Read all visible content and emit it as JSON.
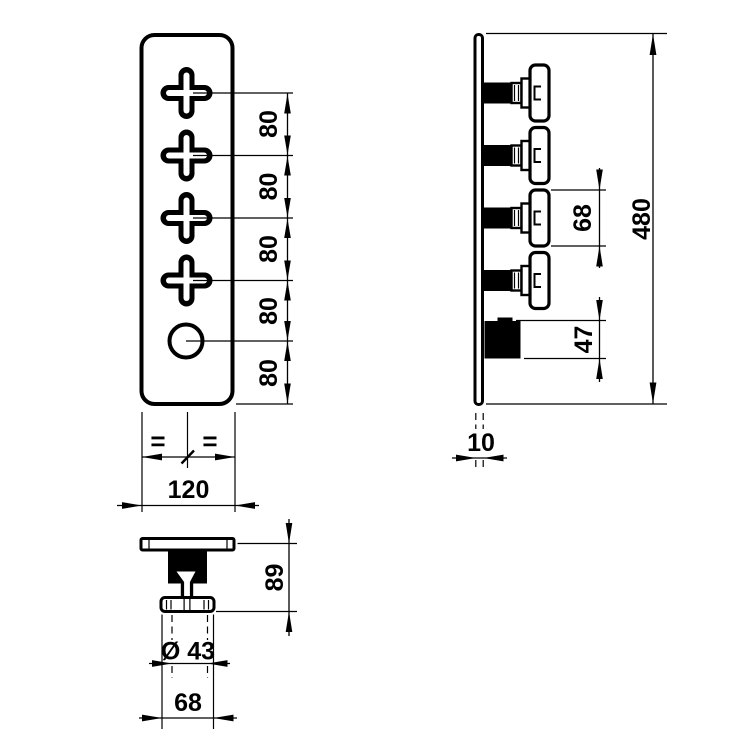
{
  "drawing": {
    "kind": "technical-dimension-drawing",
    "background_color": "#ffffff",
    "line_color": "#000000"
  },
  "front_view": {
    "spacing_dims": [
      "80",
      "80",
      "80",
      "80",
      "80"
    ],
    "equal_marks": [
      "=",
      "="
    ],
    "width_dim": "120"
  },
  "side_view": {
    "handle_dim": "68",
    "knob_dim": "47",
    "height_dim": "480",
    "thickness_dim": "10"
  },
  "detail_view": {
    "depth_dim": "89",
    "diameter_dim": "Ø 43",
    "width_dim": "68"
  }
}
